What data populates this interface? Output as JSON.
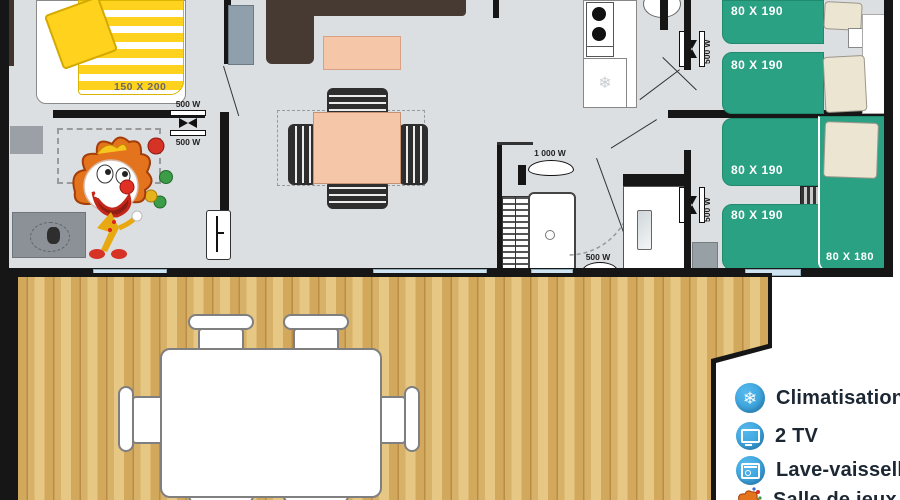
{
  "plan": {
    "master_bed_label": "150 X 200",
    "bed_labels": [
      "80 X 190",
      "80 X 190",
      "80 X 190",
      "80 X 190"
    ],
    "bunk_label": "80 X 180",
    "vent_labels": {
      "master_top": "500 W",
      "master_bottom": "500 W",
      "hall_top": "500 W",
      "hall_bottom": "500 W",
      "bath": "500 W",
      "bath_main": "1 000 W"
    }
  },
  "legend": {
    "items": [
      {
        "icon": "snowflake-icon",
        "glyph": "❄",
        "label": "Climatisation"
      },
      {
        "icon": "tv-icon",
        "label": "2 TV"
      },
      {
        "icon": "dishwasher-icon",
        "label": "Lave-vaisselle"
      },
      {
        "icon": "clown-icon",
        "label": "Salle de jeux"
      }
    ]
  },
  "colors": {
    "bed_green": "#2ba184",
    "accent_blue": "#35a3e0",
    "wood": "#d9b36c",
    "duvet_yellow": "#ffd21e",
    "table_peach": "#f6c6a8"
  }
}
